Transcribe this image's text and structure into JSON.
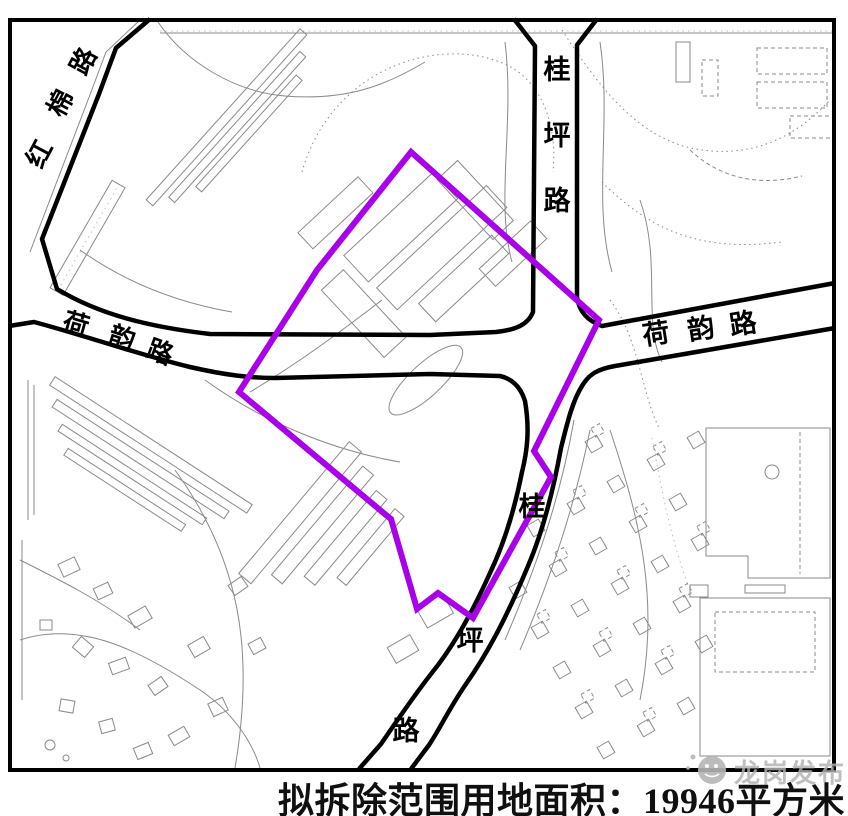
{
  "caption": {
    "text": "拟拆除范围用地面积：19946平方米",
    "area_value": "19946",
    "unit": "平方米"
  },
  "road_labels": {
    "hongmian": {
      "name": "红棉路",
      "chars": [
        "红",
        "棉",
        "路"
      ]
    },
    "guiping_north": {
      "name": "桂坪路",
      "chars": [
        "桂",
        "坪",
        "路"
      ]
    },
    "heyun_west": {
      "name": "荷韵路",
      "chars": [
        "荷",
        "韵",
        "路"
      ]
    },
    "heyun_east": {
      "name": "荷韵路",
      "chars": [
        "荷",
        "韵",
        "路"
      ]
    },
    "guiping_south": {
      "name": "桂坪路",
      "chars": [
        "桂",
        "坪",
        "路"
      ]
    }
  },
  "watermark": {
    "text": "龙岗发布"
  },
  "colors": {
    "demolition_outline": "#a800e8",
    "road": "#000000",
    "map_detail": "#8a8a8a",
    "watermark": "#b2b2b2",
    "background": "#ffffff"
  }
}
